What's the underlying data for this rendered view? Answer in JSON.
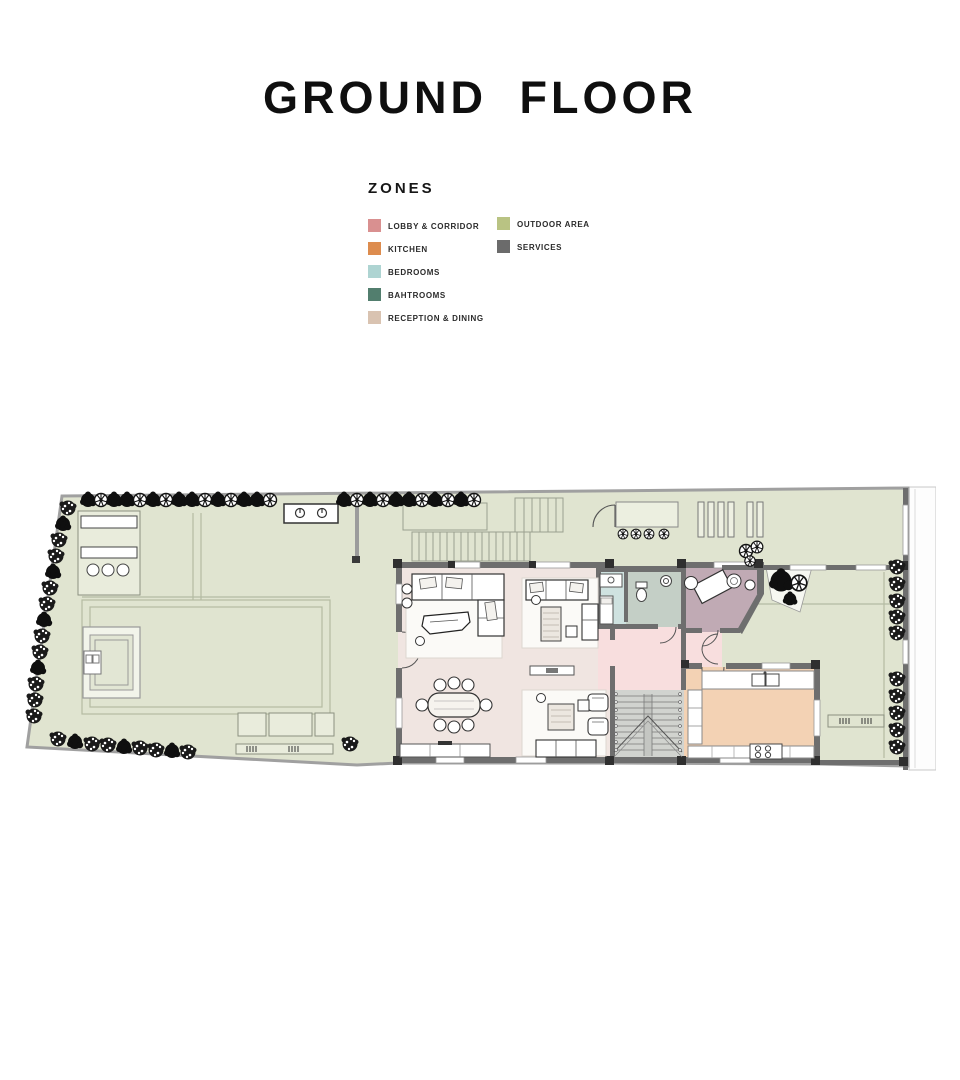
{
  "title": "GROUND FLOOR",
  "legend": {
    "heading": "ZONES",
    "items": [
      {
        "label": "LOBBY & CORRIDOR",
        "color": "#d99090"
      },
      {
        "label": "KITCHEN",
        "color": "#dd8c4e"
      },
      {
        "label": "BEDROOMS",
        "color": "#aed4d2"
      },
      {
        "label": "BAHTROOMS",
        "color": "#527e6e"
      },
      {
        "label": "RECEPTION & DINING",
        "color": "#d9c3b1"
      },
      {
        "label": "OUTDOOR AREA",
        "color": "#b9c383"
      },
      {
        "label": "SERVICES",
        "color": "#6b6b6b"
      }
    ]
  },
  "plan": {
    "zone_fills": {
      "outdoor": "#e0e4d0",
      "reception": "#f0e5e1",
      "lobby": "#f8dede",
      "kitchen": "#f3d2b4",
      "bedrooms": "#cfe2e0",
      "bathrooms": "#c4cfc6",
      "services_office": "#c0aab4",
      "stairs": "#d1d3cf",
      "walls": "#6e6e6e"
    }
  }
}
